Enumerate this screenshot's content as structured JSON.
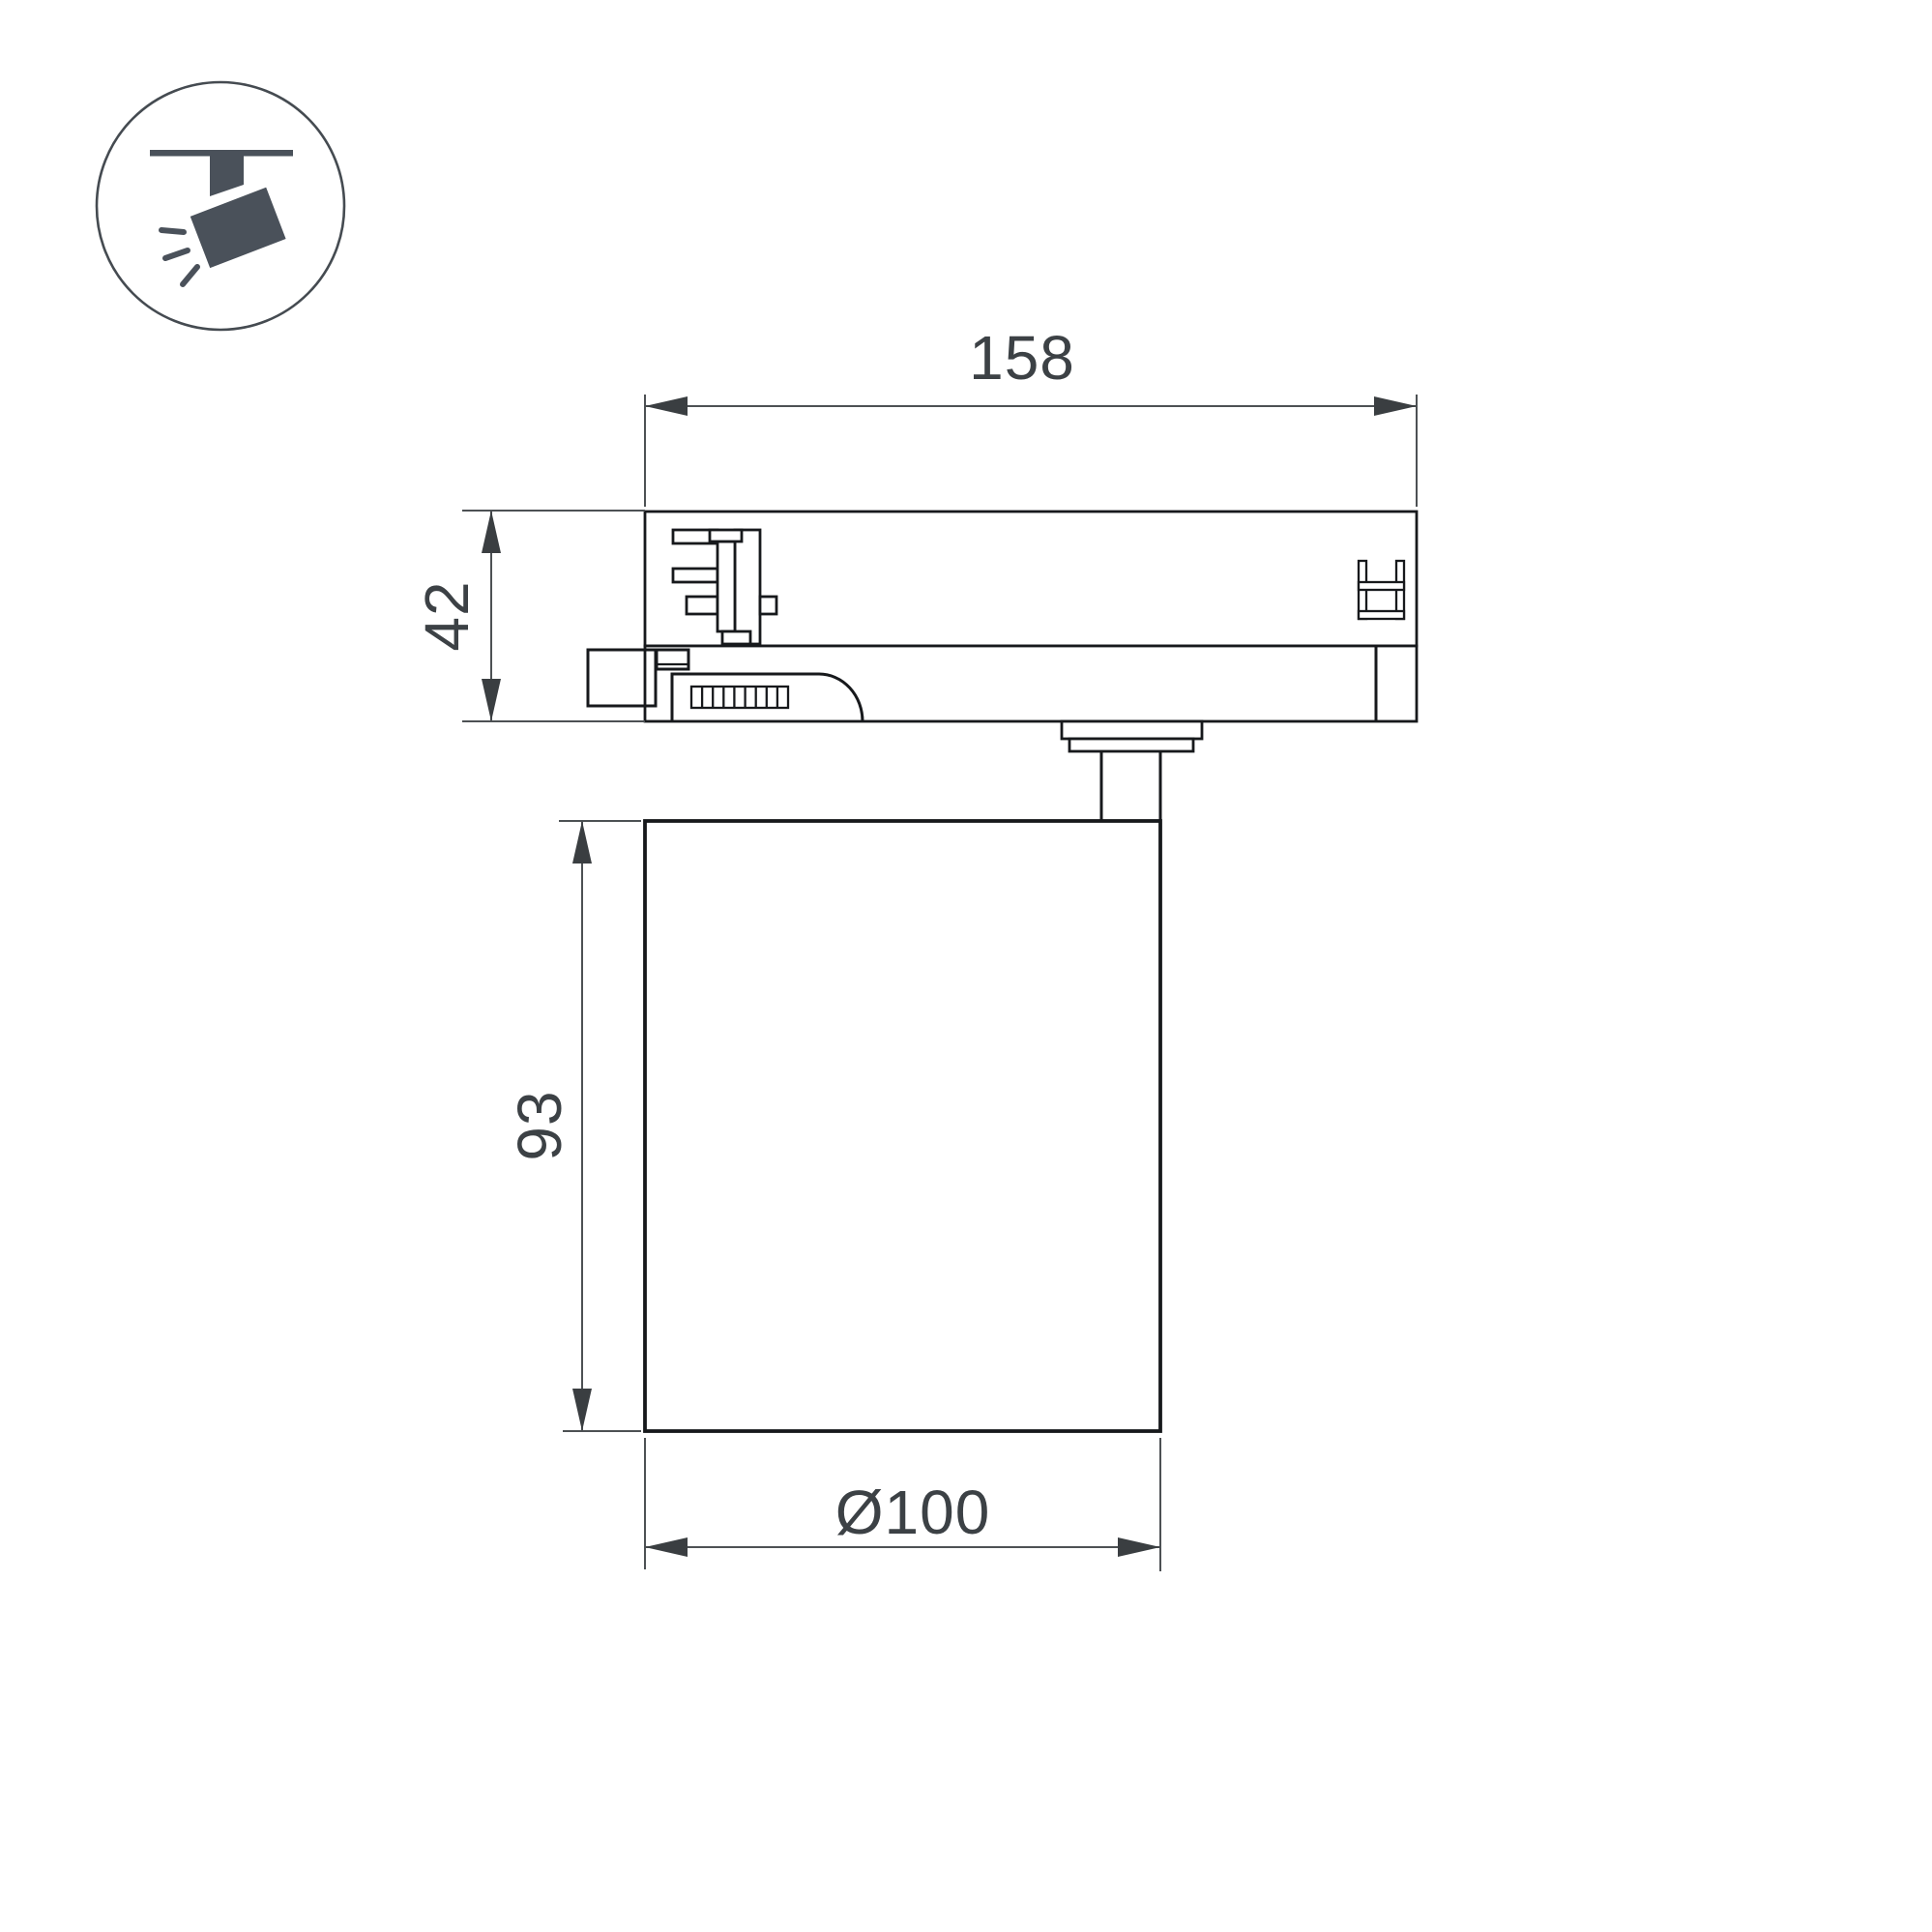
{
  "colors": {
    "bg": "#ffffff",
    "line": "#17191c",
    "dim": "#4d5154",
    "dimdark": "#3a3e41",
    "text": "#3c4145",
    "icon": "#4a515a",
    "circle": "#454b51"
  },
  "icon": {
    "name": "track-spotlight-icon"
  },
  "dimensions": {
    "track_adapter_length": "158",
    "track_adapter_height": "42",
    "lamp_body_height": "93",
    "lamp_body_diameter": "Ø100"
  }
}
